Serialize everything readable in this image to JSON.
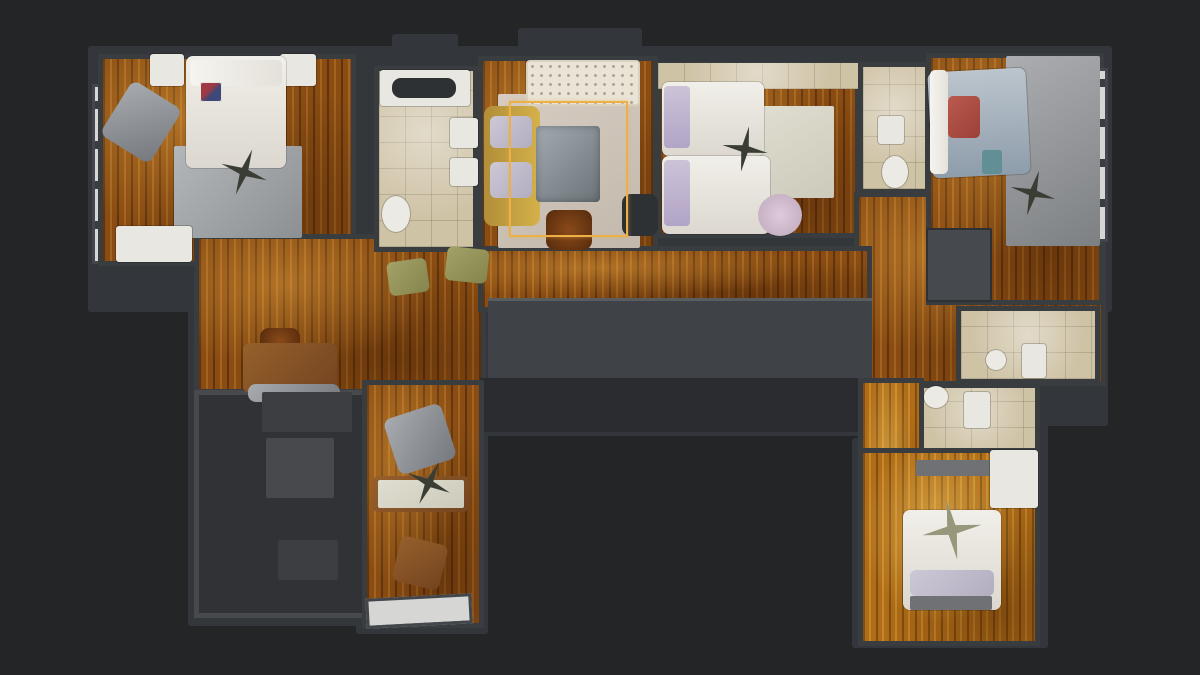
{
  "app": {
    "name": "3d-floorplan-viewer",
    "view": "top-down-floor-plan",
    "visible_text": ""
  },
  "canvas": {
    "width": 1200,
    "height": 675,
    "background": "#232527"
  },
  "colors": {
    "wall": "#3a3d40",
    "wood_floor": "#8a4c12",
    "gold_floor": "#b06c16",
    "tile_floor": "#cfc3a6",
    "selection_highlight": "#eeb045",
    "dark_room": "#303236",
    "core": "#3f4246"
  },
  "selection": {
    "name": "selected-room-highlight",
    "rect": [
      509,
      101,
      119,
      136
    ],
    "color": "#eeb045",
    "room": "living-room"
  },
  "plates": [
    {
      "name": "wall-slab-top-band",
      "cls": "plate",
      "rect": [
        88,
        46,
        1024,
        266
      ]
    },
    {
      "name": "wall-slab-vent-1",
      "cls": "plate",
      "rect": [
        392,
        34,
        66,
        28
      ]
    },
    {
      "name": "wall-slab-vent-2",
      "cls": "plate",
      "rect": [
        518,
        28,
        124,
        36
      ]
    },
    {
      "name": "wall-slab-left-extension",
      "cls": "plate",
      "rect": [
        188,
        230,
        300,
        172
      ]
    },
    {
      "name": "wall-slab-core",
      "cls": "plate",
      "rect": [
        476,
        294,
        402,
        142
      ]
    },
    {
      "name": "wall-slab-right-extension",
      "cls": "plate",
      "rect": [
        850,
        226,
        258,
        200
      ]
    },
    {
      "name": "wall-slab-bottom-left",
      "cls": "plate",
      "rect": [
        188,
        384,
        192,
        242
      ]
    },
    {
      "name": "wall-slab-office",
      "cls": "plate",
      "rect": [
        356,
        376,
        132,
        258
      ]
    },
    {
      "name": "wall-slab-bath-lower",
      "cls": "plate",
      "rect": [
        908,
        376,
        140,
        90
      ]
    },
    {
      "name": "wall-slab-bottom-bedroom",
      "cls": "plate",
      "rect": [
        852,
        438,
        196,
        210
      ]
    }
  ],
  "rooms": [
    {
      "name": "room-balcony-left",
      "cls": "ledge",
      "rect": [
        92,
        84,
        26,
        180
      ],
      "interactable": true
    },
    {
      "name": "room-master-bedroom",
      "cls": "room wood",
      "rect": [
        98,
        54,
        258,
        212
      ],
      "interactable": true
    },
    {
      "name": "room-living-dining-left",
      "cls": "room wood",
      "rect": [
        194,
        234,
        292,
        160
      ],
      "interactable": true
    },
    {
      "name": "room-main-bathroom",
      "cls": "room tile",
      "rect": [
        374,
        66,
        104,
        186
      ],
      "interactable": true
    },
    {
      "name": "room-living-room",
      "cls": "room wood",
      "rect": [
        478,
        56,
        180,
        198
      ],
      "interactable": true
    },
    {
      "name": "room-twin-bedroom",
      "cls": "room wood",
      "rect": [
        656,
        62,
        204,
        176
      ],
      "interactable": true
    },
    {
      "name": "room-ensuite-bathroom",
      "cls": "room tile",
      "rect": [
        858,
        62,
        72,
        132
      ],
      "interactable": true
    },
    {
      "name": "room-right-hall",
      "cls": "room wood",
      "rect": [
        854,
        192,
        252,
        194
      ],
      "interactable": true
    },
    {
      "name": "room-right-bedroom",
      "cls": "room wood",
      "rect": [
        926,
        53,
        178,
        252
      ],
      "interactable": true
    },
    {
      "name": "room-balcony-right",
      "cls": "ledge",
      "rect": [
        1066,
        68,
        42,
        174
      ],
      "interactable": true
    },
    {
      "name": "room-corridor",
      "cls": "room wood",
      "rect": [
        478,
        246,
        394,
        66
      ],
      "interactable": true
    },
    {
      "name": "room-stair-core",
      "cls": "core",
      "rect": [
        488,
        298,
        384,
        82
      ],
      "interactable": true
    },
    {
      "name": "room-core-shadow",
      "cls": "core-dark",
      "rect": [
        480,
        378,
        392,
        54
      ],
      "interactable": false
    },
    {
      "name": "room-bottom-left-dark",
      "cls": "darkroom",
      "rect": [
        194,
        390,
        176,
        228
      ],
      "interactable": true
    },
    {
      "name": "room-office",
      "cls": "room wood",
      "rect": [
        362,
        380,
        122,
        248
      ],
      "interactable": true
    },
    {
      "name": "room-bath-upper",
      "cls": "room tile",
      "rect": [
        956,
        306,
        144,
        78
      ],
      "interactable": true
    },
    {
      "name": "room-bath-lower",
      "cls": "room tile",
      "rect": [
        914,
        383,
        126,
        76
      ],
      "interactable": true
    },
    {
      "name": "room-bottom-hall",
      "cls": "room wood-gold",
      "rect": [
        858,
        378,
        66,
        268
      ],
      "interactable": true
    },
    {
      "name": "room-bottom-bedroom",
      "cls": "room wood-gold",
      "rect": [
        858,
        448,
        182,
        198
      ],
      "interactable": true
    }
  ],
  "furniture": [
    {
      "name": "nightstand-left",
      "cls": "white",
      "rect": [
        150,
        54,
        34,
        32
      ]
    },
    {
      "name": "nightstand-right",
      "cls": "white",
      "rect": [
        280,
        54,
        36,
        32
      ]
    },
    {
      "name": "rug-master",
      "cls": "ruglight",
      "rect": [
        174,
        146,
        128,
        92
      ]
    },
    {
      "name": "bed-master",
      "cls": "bedwhite",
      "rect": [
        186,
        56,
        100,
        112
      ]
    },
    {
      "name": "bed-master-pillows",
      "cls": "pillow",
      "rect": [
        190,
        60,
        92,
        26
      ]
    },
    {
      "name": "union-jack-pillow",
      "cls": "uj",
      "rect": [
        200,
        82,
        22,
        20
      ]
    },
    {
      "name": "armchair-master",
      "cls": "chairgray",
      "rect": [
        112,
        90,
        58,
        64
      ],
      "rot": 32
    },
    {
      "name": "dresser-master",
      "cls": "white",
      "rect": [
        116,
        226,
        76,
        36
      ]
    },
    {
      "name": "ceiling-fan-master",
      "cls": "fan",
      "rect": [
        220,
        148,
        48,
        48
      ],
      "rot": 20
    },
    {
      "name": "side-table-box",
      "cls": "stoolwood",
      "rect": [
        260,
        328,
        40,
        26
      ]
    },
    {
      "name": "desk-left",
      "cls": "brown",
      "rect": [
        243,
        343,
        94,
        50
      ]
    },
    {
      "name": "chairs-left",
      "cls": "chairgray",
      "rect": [
        248,
        384,
        92,
        18
      ]
    },
    {
      "name": "dining-chair-1",
      "cls": "olive",
      "rect": [
        388,
        260,
        40,
        34
      ],
      "rot": -8
    },
    {
      "name": "dining-chair-2",
      "cls": "olive",
      "rect": [
        446,
        248,
        42,
        34
      ],
      "rot": 6
    },
    {
      "name": "bathtub",
      "cls": "white",
      "rect": [
        380,
        70,
        90,
        36
      ]
    },
    {
      "name": "bathtub-basin",
      "cls": "darkinner",
      "rect": [
        392,
        78,
        64,
        20
      ]
    },
    {
      "name": "sink-main-1",
      "cls": "white",
      "rect": [
        450,
        118,
        28,
        30
      ]
    },
    {
      "name": "sink-main-2",
      "cls": "white",
      "rect": [
        450,
        158,
        28,
        28
      ]
    },
    {
      "name": "toilet-main",
      "cls": "whiteround",
      "rect": [
        382,
        196,
        28,
        36
      ]
    },
    {
      "name": "rug-living",
      "cls": "rugbeige",
      "rect": [
        498,
        94,
        142,
        154
      ]
    },
    {
      "name": "tufted-headboard",
      "cls": "tuft",
      "rect": [
        526,
        60,
        114,
        46
      ]
    },
    {
      "name": "sofa-yellow",
      "cls": "sofa",
      "rect": [
        484,
        106,
        56,
        120
      ]
    },
    {
      "name": "sofa-cushion-1",
      "cls": "cushion",
      "rect": [
        490,
        116,
        42,
        32
      ]
    },
    {
      "name": "sofa-cushion-2",
      "cls": "cushion",
      "rect": [
        490,
        162,
        42,
        36
      ]
    },
    {
      "name": "ottoman-living",
      "cls": "ottoman",
      "rect": [
        536,
        126,
        64,
        76
      ]
    },
    {
      "name": "coffee-stool",
      "cls": "stoolwood",
      "rect": [
        546,
        210,
        46,
        40
      ]
    },
    {
      "name": "side-table-dark",
      "cls": "darkinner",
      "rect": [
        622,
        194,
        36,
        42
      ]
    },
    {
      "name": "closet-strip-twin",
      "cls": "tile",
      "rect": [
        658,
        63,
        200,
        26
      ]
    },
    {
      "name": "rug-twin",
      "cls": "rugpale",
      "rect": [
        750,
        106,
        84,
        92
      ]
    },
    {
      "name": "bed-twin-1",
      "cls": "bedwhite",
      "rect": [
        662,
        82,
        102,
        74
      ]
    },
    {
      "name": "pillow-twin-1",
      "cls": "lavender",
      "rect": [
        664,
        86,
        26,
        62
      ]
    },
    {
      "name": "bed-twin-2",
      "cls": "bedwhite",
      "rect": [
        662,
        156,
        108,
        78
      ]
    },
    {
      "name": "pillow-twin-2",
      "cls": "lavender",
      "rect": [
        664,
        160,
        26,
        66
      ]
    },
    {
      "name": "ceiling-fan-twin",
      "cls": "fan",
      "rect": [
        722,
        126,
        46,
        46
      ],
      "rot": 10
    },
    {
      "name": "chair-pink",
      "cls": "pinkchair",
      "rect": [
        758,
        194,
        44,
        42
      ]
    },
    {
      "name": "sink-ensuite",
      "cls": "white",
      "rect": [
        878,
        116,
        26,
        28
      ]
    },
    {
      "name": "toilet-ensuite",
      "cls": "whiteround",
      "rect": [
        882,
        156,
        26,
        32
      ]
    },
    {
      "name": "rug-right-bedroom",
      "cls": "ruggray",
      "rect": [
        1006,
        56,
        94,
        190
      ]
    },
    {
      "name": "bed-right",
      "cls": "bedblue",
      "rect": [
        930,
        70,
        98,
        106
      ],
      "rot": -3
    },
    {
      "name": "headboard-right",
      "cls": "pillow",
      "rect": [
        930,
        70,
        18,
        104
      ]
    },
    {
      "name": "cushions-red",
      "cls": "redpillow",
      "rect": [
        948,
        96,
        32,
        42
      ]
    },
    {
      "name": "ceiling-fan-right",
      "cls": "fan",
      "rect": [
        1010,
        170,
        46,
        46
      ],
      "rot": 15
    },
    {
      "name": "wardrobe-right",
      "cls": "wardrobe",
      "rect": [
        926,
        228,
        66,
        74
      ]
    },
    {
      "name": "stool-teal",
      "cls": "teal",
      "rect": [
        982,
        150,
        20,
        24
      ]
    },
    {
      "name": "sink-bath-upper",
      "cls": "whiteround",
      "rect": [
        986,
        350,
        20,
        20
      ]
    },
    {
      "name": "toilet-bath-upper",
      "cls": "white",
      "rect": [
        1022,
        344,
        24,
        34
      ]
    },
    {
      "name": "sink-bath-lower",
      "cls": "whiteround",
      "rect": [
        924,
        386,
        24,
        22
      ]
    },
    {
      "name": "toilet-bath-lower",
      "cls": "white",
      "rect": [
        964,
        392,
        26,
        36
      ]
    },
    {
      "name": "patch-bright-darkroom",
      "cls": "patch",
      "rect": [
        266,
        438,
        68,
        60
      ]
    },
    {
      "name": "patch-dim-1",
      "cls": "patch2",
      "rect": [
        262,
        392,
        90,
        40
      ]
    },
    {
      "name": "patch-dim-2",
      "cls": "patch2",
      "rect": [
        278,
        540,
        60,
        40
      ]
    },
    {
      "name": "office-chair",
      "cls": "chairgray",
      "rect": [
        390,
        410,
        60,
        58
      ],
      "rot": -18
    },
    {
      "name": "office-desk",
      "cls": "brown",
      "rect": [
        372,
        476,
        98,
        36
      ]
    },
    {
      "name": "office-desk-top",
      "cls": "rugpale",
      "rect": [
        378,
        480,
        86,
        28
      ]
    },
    {
      "name": "ceiling-fan-office",
      "cls": "fan",
      "rect": [
        406,
        460,
        46,
        46
      ],
      "rot": 25
    },
    {
      "name": "office-chair-brown",
      "cls": "brown",
      "rect": [
        396,
        540,
        48,
        46
      ],
      "rot": 14
    },
    {
      "name": "office-ledge",
      "cls": "ledge",
      "rect": [
        366,
        596,
        106,
        30
      ],
      "rot": -3
    },
    {
      "name": "shelf-bottom-bedroom",
      "cls": "grayshelf",
      "rect": [
        916,
        460,
        78,
        16
      ]
    },
    {
      "name": "wardrobe-bottom-bedroom",
      "cls": "white",
      "rect": [
        990,
        450,
        48,
        58
      ]
    },
    {
      "name": "bed-bottom",
      "cls": "bedwhite",
      "rect": [
        903,
        510,
        98,
        100
      ]
    },
    {
      "name": "pillows-bottom",
      "cls": "cushion",
      "rect": [
        910,
        570,
        84,
        26
      ]
    },
    {
      "name": "bench-bottom",
      "cls": "grayshelf",
      "rect": [
        910,
        596,
        82,
        14
      ]
    },
    {
      "name": "star-fan-bottom-bedroom",
      "cls": "fanlight",
      "rect": [
        922,
        500,
        60,
        60
      ],
      "rot": -10
    }
  ]
}
